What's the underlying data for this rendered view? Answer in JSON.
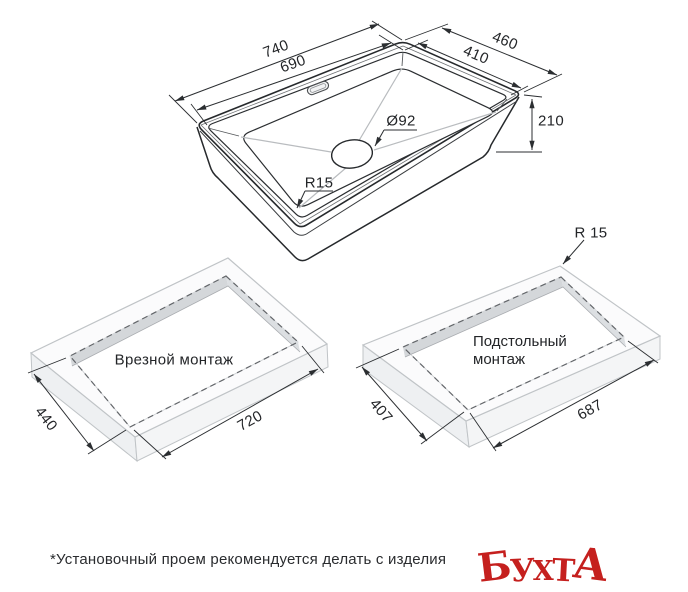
{
  "sink_diagram": {
    "outer_length": "740",
    "inner_length": "690",
    "outer_width": "460",
    "inner_width": "410",
    "height": "210",
    "drain_diameter": "Ø92",
    "corner_radius": "R15"
  },
  "inset_mount": {
    "label": "Врезной монтаж",
    "cutout_width": "440",
    "cutout_length": "720"
  },
  "under_mount": {
    "label_line1": "Подстольный",
    "label_line2": "монтаж",
    "cutout_width": "407",
    "cutout_length": "687",
    "corner_radius": "R 15"
  },
  "footnote": "*Установочный проем рекомендуется делать с изделия",
  "logo": {
    "text": "БУХТА",
    "letters": [
      "Б",
      "У",
      "Х",
      "Т",
      "А"
    ],
    "color": "#c5201e"
  },
  "colors": {
    "line": "#2b2e31",
    "dashed": "#63666a",
    "slab_edge": "#c0c4c7",
    "slab_top": "#fbfbfc",
    "slab_side": "#eef0f2",
    "cut_wall": "#d4d7da",
    "background": "#ffffff"
  }
}
